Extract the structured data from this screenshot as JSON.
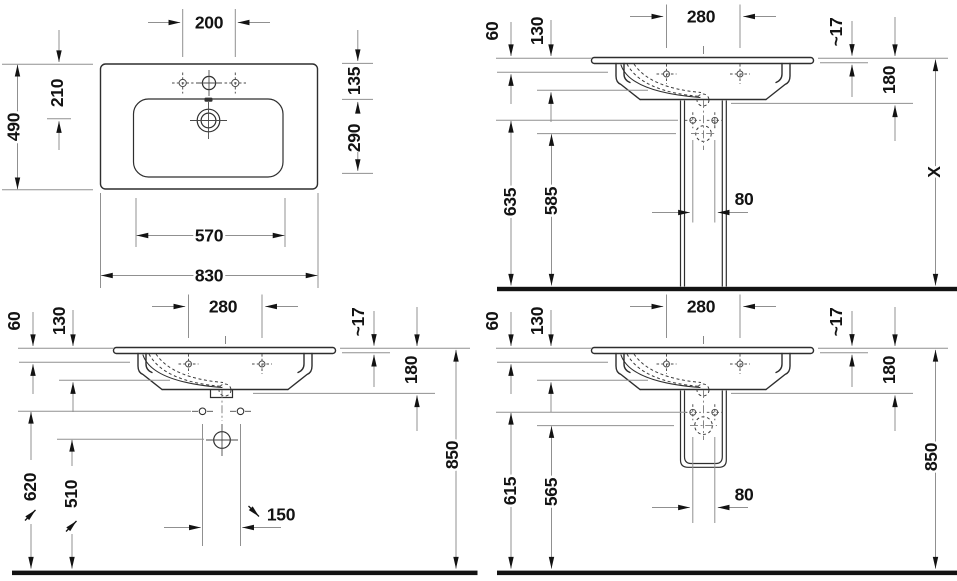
{
  "drawing": {
    "product": "washbasin-technical-drawing",
    "views": {
      "plan": {
        "tap_hole_spacing": "200",
        "overall_depth": "490",
        "rear_to_outlet": "210",
        "rim_to_bowl": "135",
        "bowl_depth": "290",
        "bowl_width": "570",
        "overall_width": "830"
      },
      "front_pedestal": {
        "tap_hole_spacing": "280",
        "rim_drop_outer": "60",
        "rim_drop_inner": "130",
        "rim_thickness": "~17",
        "basin_depth": "180",
        "fixing_hole_height": "635",
        "outlet_height": "585",
        "fixing_hole_spacing": "80",
        "overall_height": "X"
      },
      "front_wall_mounted": {
        "tap_hole_spacing": "280",
        "rim_drop_outer": "60",
        "rim_drop_inner": "130",
        "rim_thickness": "~17",
        "basin_depth": "180",
        "fixing_hole_height": "620",
        "outlet_height": "510",
        "fixing_hole_spacing": "150",
        "overall_height": "850"
      },
      "front_half_pedestal": {
        "tap_hole_spacing": "280",
        "rim_drop_outer": "60",
        "rim_drop_inner": "130",
        "rim_thickness": "~17",
        "basin_depth": "180",
        "fixing_hole_height": "615",
        "outlet_height": "565",
        "fixing_hole_spacing": "80",
        "overall_height": "850"
      }
    },
    "colors": {
      "background": "#ffffff",
      "object_line": "#2e2e2e",
      "dimension_line": "#909090",
      "text": "#131313",
      "floor": "#131313"
    }
  }
}
